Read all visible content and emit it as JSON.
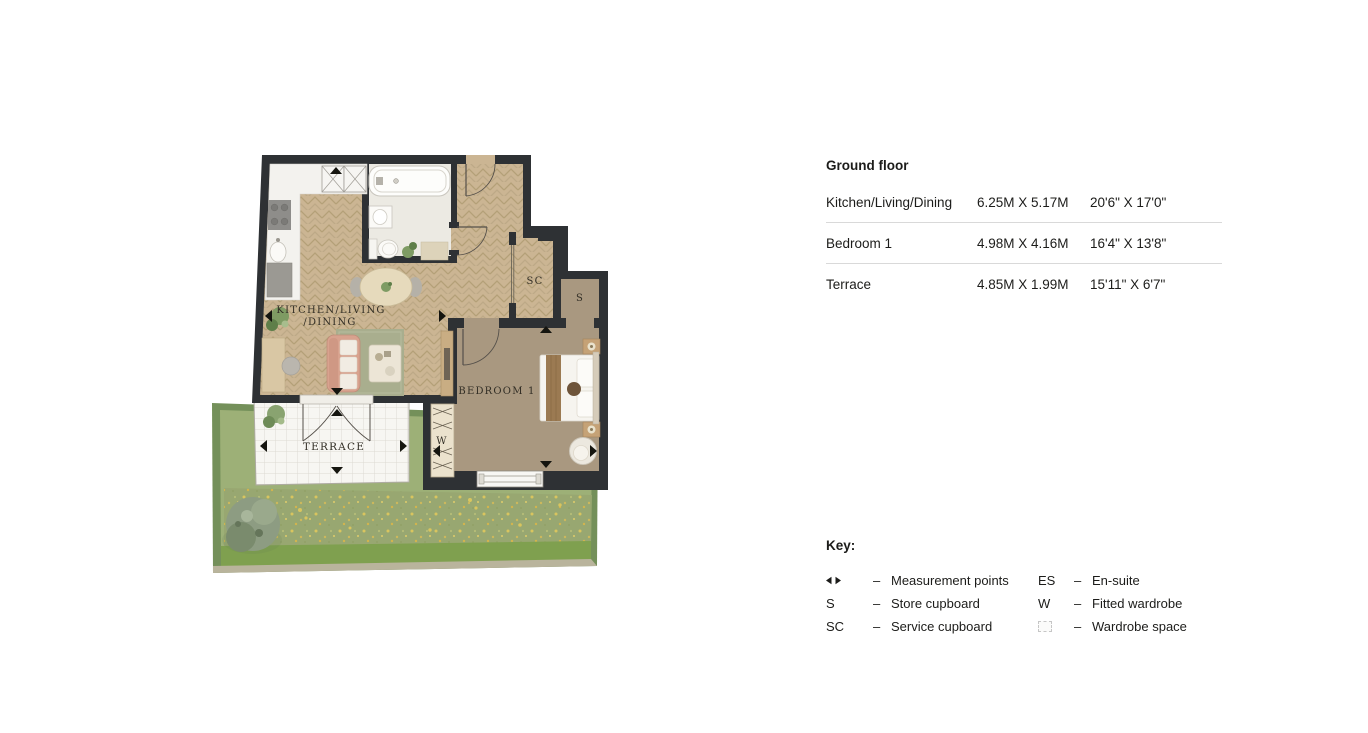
{
  "floorplan": {
    "labels": {
      "kitchen_line1": "KITCHEN/LIVING",
      "kitchen_line2": "/DINING",
      "bedroom": "BEDROOM 1",
      "terrace": "TERRACE",
      "service_cupboard": "SC",
      "store_cupboard": "S",
      "wardrobe": "W"
    }
  },
  "dimensions_table": {
    "title": "Ground floor",
    "rows": [
      {
        "room": "Kitchen/Living/Dining",
        "metric": "6.25M X 5.17M",
        "imperial": "20'6\" X 17'0\""
      },
      {
        "room": "Bedroom 1",
        "metric": "4.98M X 4.16M",
        "imperial": "16'4\" X 13'8\""
      },
      {
        "room": "Terrace",
        "metric": "4.85M X 1.99M",
        "imperial": "15'11\" X 6'7\""
      }
    ]
  },
  "key": {
    "title": "Key:",
    "dash": "–",
    "left": [
      {
        "abbr": "",
        "label": "Measurement points"
      },
      {
        "abbr": "S",
        "label": "Store cupboard"
      },
      {
        "abbr": "SC",
        "label": "Service cupboard"
      }
    ],
    "right": [
      {
        "abbr": "ES",
        "label": "En-suite"
      },
      {
        "abbr": "W",
        "label": "Fitted wardrobe"
      },
      {
        "abbr": "",
        "label": "Wardrobe space"
      }
    ]
  },
  "colors": {
    "wall": "#2e3134",
    "wood_floor": "#cbb593",
    "carpet": "#a99880",
    "bathroom_floor": "#eceae3",
    "grass": "#9db077",
    "hedge": "#74905a",
    "terrace_tile": "#f7f6f2",
    "sofa": "#d8a28e",
    "rug": "#a9ae8e",
    "text": "#1c1c1a"
  }
}
